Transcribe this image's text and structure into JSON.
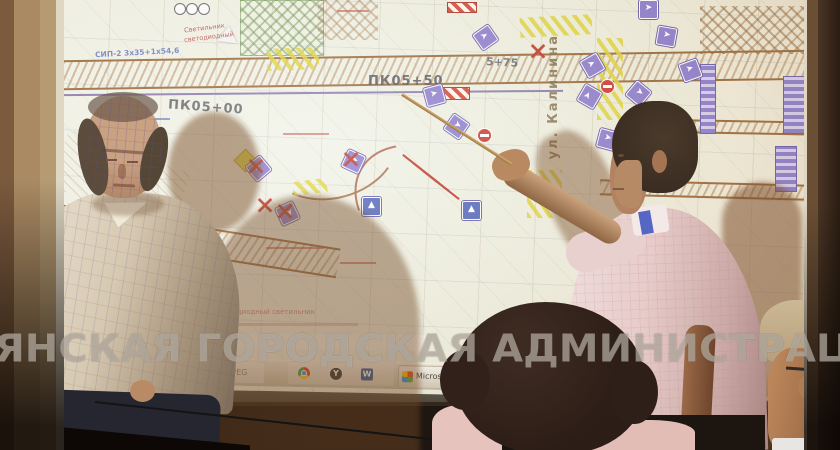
{
  "watermark": {
    "text": "ЯНСКАЯ ГОРОДСКАЯ АДМИНИСТРАЦИЯ"
  },
  "map": {
    "labels": {
      "station_left": "ПК05+00",
      "station_center": "ПК05+50",
      "station_right": "5+75",
      "street_vertical": "ул. Калинина",
      "cable": "СИП-2 3х35+1х54,6",
      "luminaire_line1": "Светильник",
      "luminaire_line2": "светодиодный",
      "legend_heading": "ния",
      "legend_item": "- новый светодиодный светильник"
    },
    "x_glyph": "✕",
    "arrow_glyph": "➤",
    "ped_glyph": "▲",
    "signs": [
      {
        "x": 249,
        "y": 159,
        "r": -40,
        "kind": "arrow",
        "crossed": true
      },
      {
        "x": 344,
        "y": 152,
        "r": 25,
        "kind": "arrow",
        "crossed": true
      },
      {
        "x": 278,
        "y": 204,
        "r": 65,
        "kind": "arrow",
        "crossed": true
      },
      {
        "x": 425,
        "y": 86,
        "r": -15,
        "kind": "arrow",
        "crossed": false
      },
      {
        "x": 447,
        "y": 117,
        "r": 35,
        "kind": "arrow",
        "crossed": false
      },
      {
        "x": 476,
        "y": 28,
        "r": -35,
        "kind": "arrow",
        "crossed": false
      },
      {
        "x": 462,
        "y": 201,
        "r": 0,
        "kind": "ped",
        "crossed": false
      },
      {
        "x": 362,
        "y": 197,
        "r": 0,
        "kind": "ped",
        "crossed": false
      },
      {
        "x": 583,
        "y": 56,
        "r": -30,
        "kind": "arrow",
        "crossed": false
      },
      {
        "x": 580,
        "y": 87,
        "r": -60,
        "kind": "arrow",
        "crossed": false
      },
      {
        "x": 598,
        "y": 130,
        "r": 15,
        "kind": "arrow",
        "crossed": false
      },
      {
        "x": 629,
        "y": 84,
        "r": 40,
        "kind": "arrow",
        "crossed": false
      },
      {
        "x": 681,
        "y": 61,
        "r": -20,
        "kind": "arrow",
        "crossed": false
      },
      {
        "x": 657,
        "y": 27,
        "r": 10,
        "kind": "arrow",
        "crossed": false
      },
      {
        "x": 639,
        "y": 0,
        "r": 0,
        "kind": "arrow",
        "crossed": false
      }
    ],
    "x_marks": [
      {
        "x": 255,
        "y": 194
      },
      {
        "x": 528,
        "y": 40
      }
    ],
    "no_entry": [
      {
        "x": 477,
        "y": 128
      },
      {
        "x": 600,
        "y": 79
      }
    ]
  },
  "taskbar": {
    "left_button": "кк...",
    "folder_label": "JPEG",
    "office_button": "Microsoft Of",
    "language": "RU",
    "yandex_glyph": "Y",
    "word_glyph": "W"
  },
  "colors": {
    "accent_purple": "#8d7fd0",
    "hatch_yellow": "#e2d83c",
    "mark_red": "#c0392b"
  }
}
